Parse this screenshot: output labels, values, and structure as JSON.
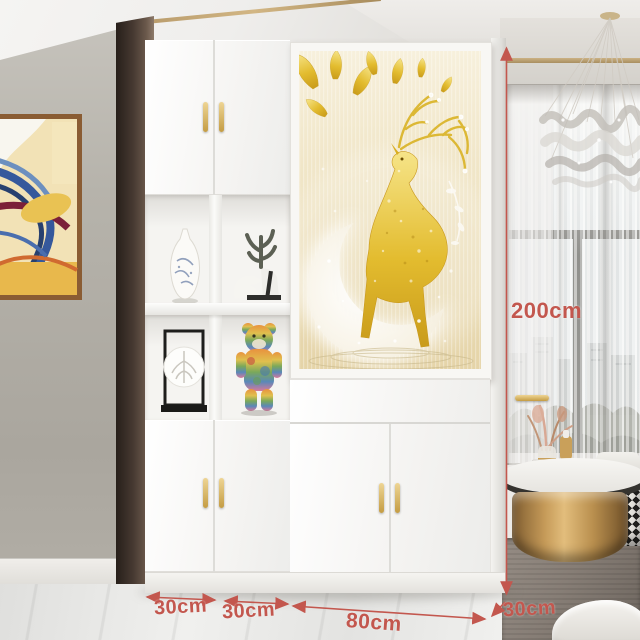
{
  "annotations": {
    "height_label": "200cm",
    "bottom_labels": [
      "30cm",
      "30cm",
      "80cm",
      "30cm"
    ],
    "line_color": "#c3574e"
  },
  "palette": {
    "cabinet_white": "#fbfbf9",
    "handle_gold": "#d2a855",
    "screen_art_gold": "#e3bc2f",
    "screen_art_background": "#ecdfbc",
    "wall_gray": "#b4b1aa",
    "painting_frame_wood": "#8a5c33",
    "coffee_table_gold": "#b3854a",
    "floor_marble": "#e9e9e7"
  },
  "scene": {
    "product": "white hallway divider cabinet with decorative screen panel",
    "screen_art": "golden deer with antlers standing on glowing crescent moon, gold ginkgo leaves",
    "shelf_items": [
      "blue-and-white porcelain vase",
      "coral branch with white figurine",
      "black framed leaf decor",
      "multicolor bear art toy"
    ],
    "room_items": [
      "abstract swirl wall painting",
      "crystal chandelier",
      "sheer curtains",
      "city view window",
      "gold round coffee table",
      "houndstooth ottoman",
      "stacked books",
      "dried flower vase",
      "gray rug"
    ]
  }
}
